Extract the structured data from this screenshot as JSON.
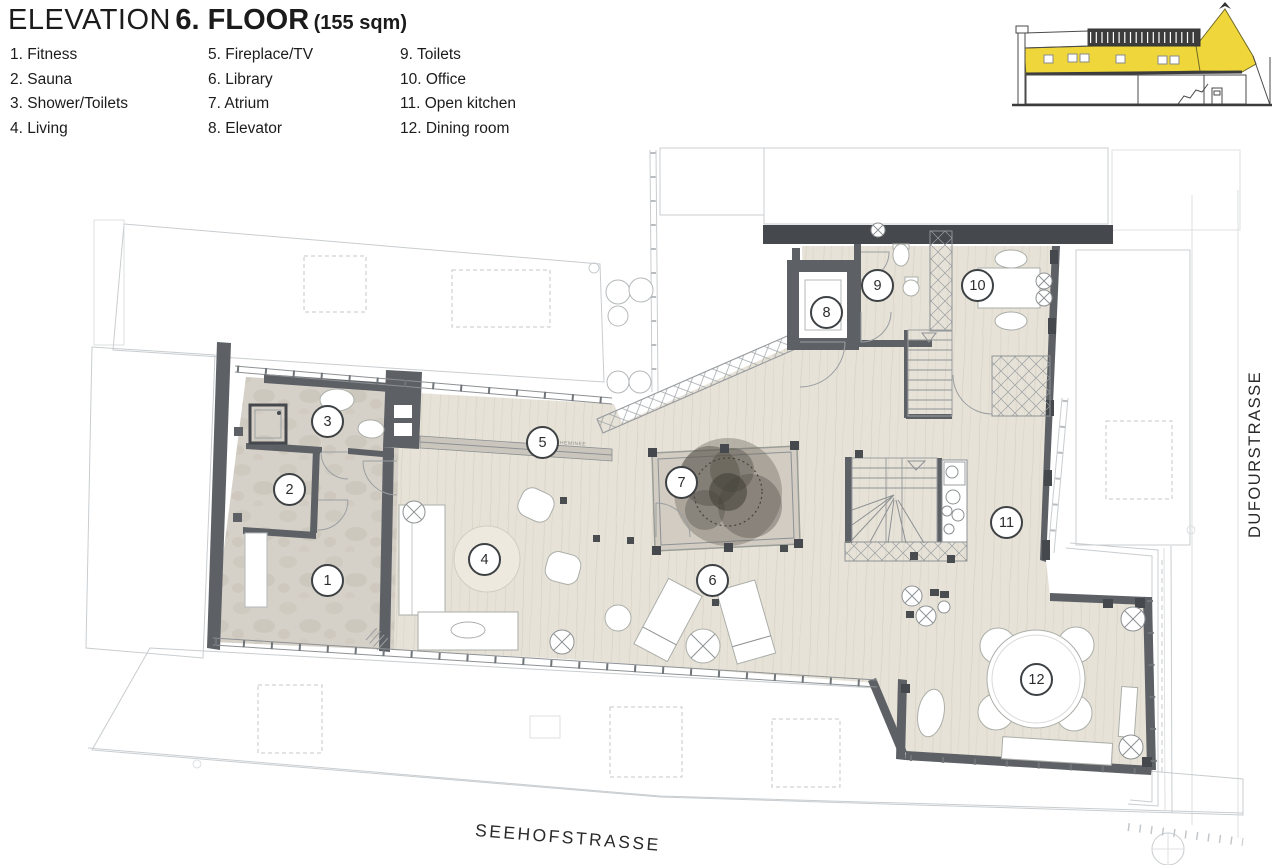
{
  "title": {
    "prefix": "ELEVATION",
    "floor": "6. FLOOR",
    "area": "(155 sqm)"
  },
  "legend": {
    "columns": [
      [
        "1. Fitness",
        "2. Sauna",
        "3. Shower/Toilets",
        "4. Living"
      ],
      [
        "5. Fireplace/TV",
        "6. Library",
        "7. Atrium",
        "8. Elevator"
      ],
      [
        "9. Toilets",
        "10. Office",
        "11. Open kitchen",
        "12. Dining room"
      ]
    ]
  },
  "streets": {
    "bottom": "SEEHOFSTRASSE",
    "right": "DUFOURSTRASSE"
  },
  "plan": {
    "rooms": [
      {
        "number": "1",
        "x": 327,
        "y": 580
      },
      {
        "number": "2",
        "x": 289,
        "y": 489
      },
      {
        "number": "3",
        "x": 327,
        "y": 421
      },
      {
        "number": "4",
        "x": 484,
        "y": 559
      },
      {
        "number": "5",
        "x": 542,
        "y": 442
      },
      {
        "number": "6",
        "x": 712,
        "y": 580
      },
      {
        "number": "7",
        "x": 681,
        "y": 482
      },
      {
        "number": "8",
        "x": 826,
        "y": 312
      },
      {
        "number": "9",
        "x": 877,
        "y": 285
      },
      {
        "number": "10",
        "x": 977,
        "y": 285
      },
      {
        "number": "11",
        "x": 1006,
        "y": 522
      },
      {
        "number": "12",
        "x": 1036,
        "y": 679
      }
    ],
    "annotations": [
      {
        "text": "CHEMINEE"
      }
    ]
  },
  "colors": {
    "wall": "#5d6165",
    "wall-dark": "#45484c",
    "wood": "#e7e2d7",
    "stone": "#d6d1c8",
    "atrium": "#d2ccc3",
    "highlight": "#efd73b",
    "text": "#1b1b1b"
  }
}
